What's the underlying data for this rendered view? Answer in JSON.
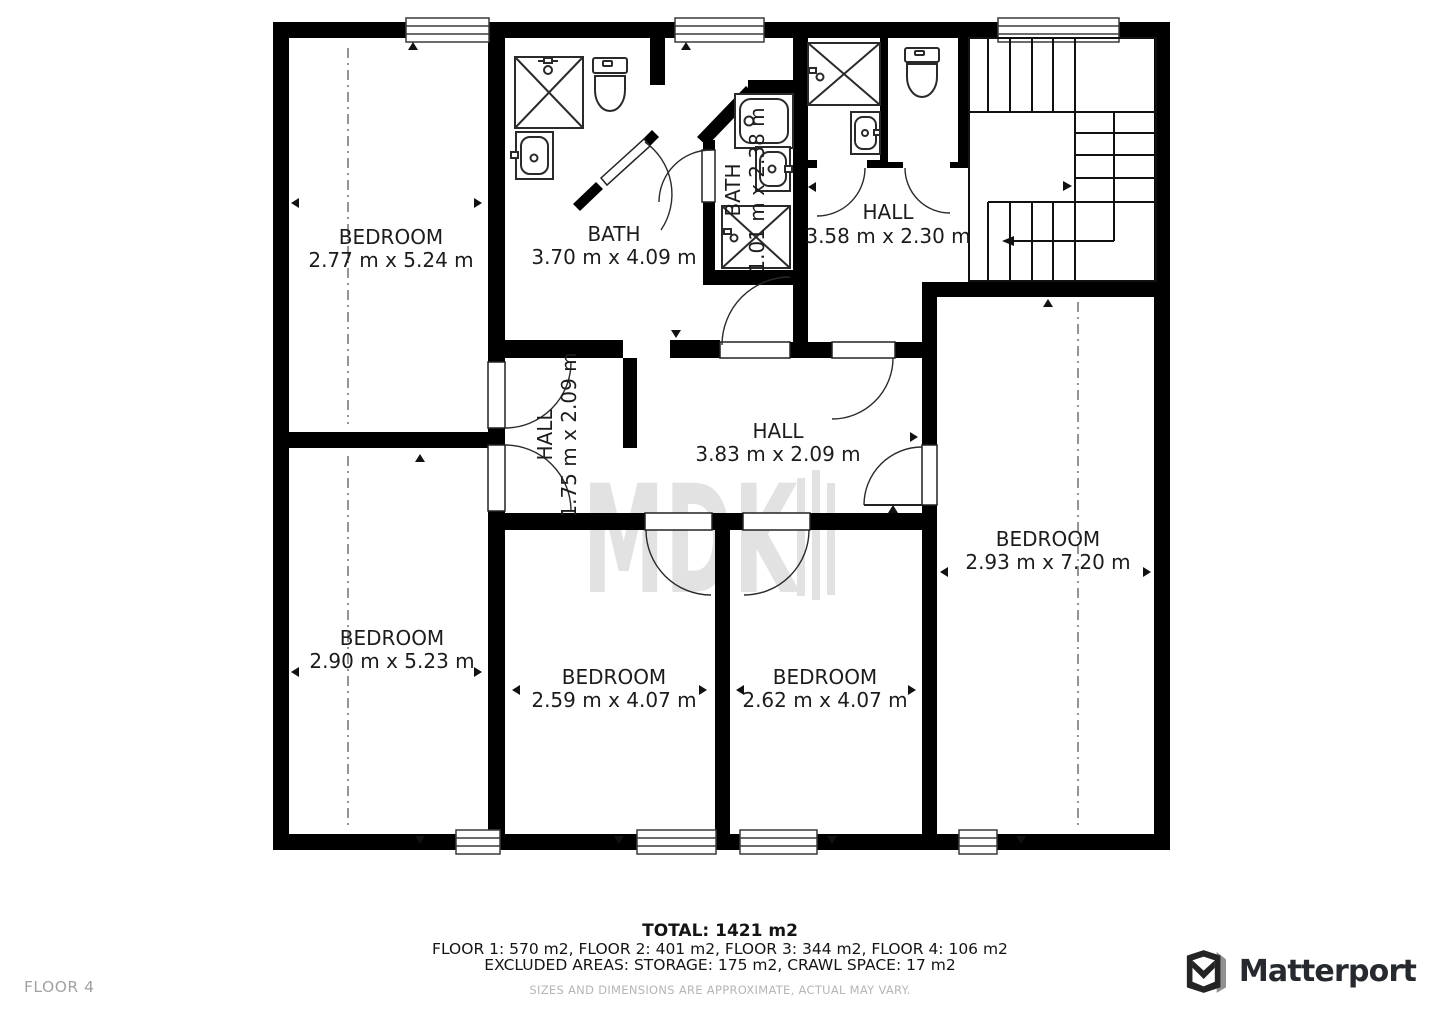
{
  "floorplan": {
    "floor_label": "FLOOR 4",
    "watermark": "MDK",
    "rooms": [
      {
        "name": "BEDROOM",
        "dims": "2.77 m x 5.24 m"
      },
      {
        "name": "BATH",
        "dims": "3.70 m x 4.09 m"
      },
      {
        "name": "BATH",
        "dims": "1.01 m x 2.38 m"
      },
      {
        "name": "HALL",
        "dims": "3.58 m x 2.30 m"
      },
      {
        "name": "HALL",
        "dims": "1.75 m x 2.09 m"
      },
      {
        "name": "HALL",
        "dims": "3.83 m x 2.09 m"
      },
      {
        "name": "BEDROOM",
        "dims": "2.93 m x 7.20 m"
      },
      {
        "name": "BEDROOM",
        "dims": "2.90 m x 5.23 m"
      },
      {
        "name": "BEDROOM",
        "dims": "2.59 m x 4.07 m"
      },
      {
        "name": "BEDROOM",
        "dims": "2.62 m x 4.07 m"
      }
    ],
    "summary": {
      "total": "TOTAL: 1421 m2",
      "floors": "FLOOR 1: 570 m2, FLOOR 2: 401 m2, FLOOR 3: 344 m2, FLOOR 4: 106 m2",
      "excluded": "EXCLUDED AREAS: STORAGE: 175 m2, CRAWL SPACE: 17 m2",
      "disclaimer": "SIZES AND DIMENSIONS ARE APPROXIMATE, ACTUAL MAY VARY."
    },
    "brand": "Matterport"
  }
}
